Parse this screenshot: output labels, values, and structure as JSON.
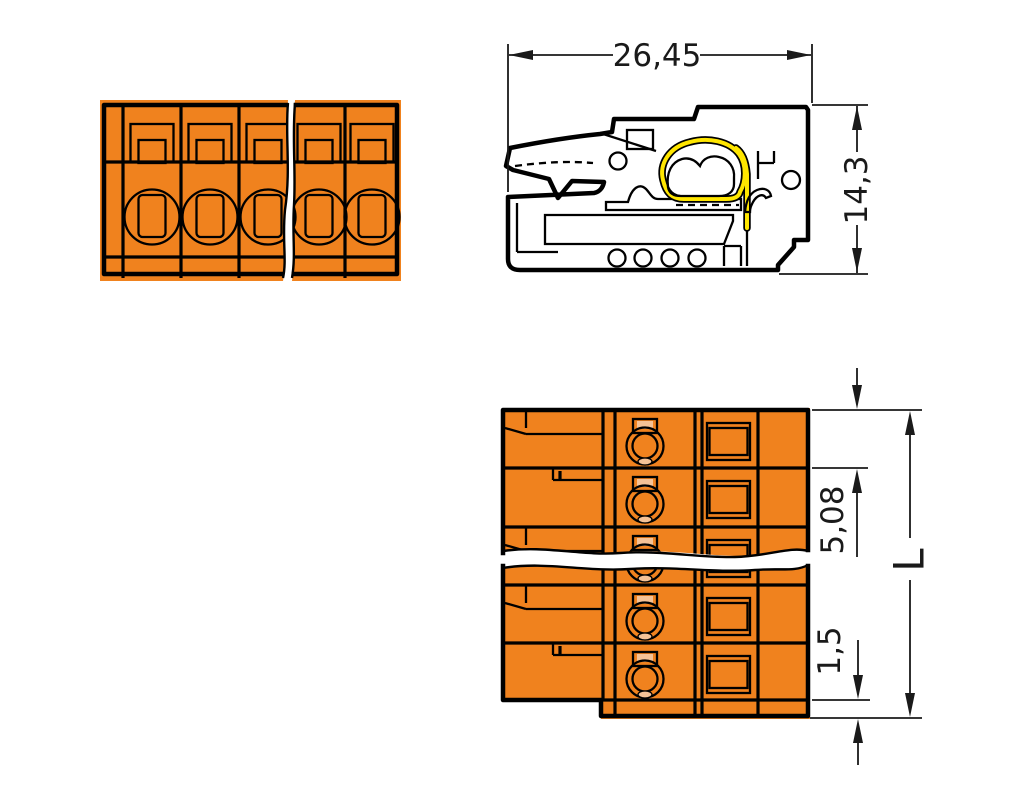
{
  "dimensions": {
    "width": "26,45",
    "height": "14,3",
    "pole_pitch": "5,08",
    "flange_offset": "1,5",
    "total_length": "L"
  },
  "colors": {
    "body-orange": "#F0821E",
    "accent-yellow": "#FFE600",
    "conductor-peach": "#F5C296",
    "line-black": "#000000",
    "dim-line": "#1a1a1a",
    "background": "#ffffff"
  },
  "views": {
    "front_poles_visible": 5,
    "bottom_rows_visible": 5,
    "has_break_lines": true
  }
}
